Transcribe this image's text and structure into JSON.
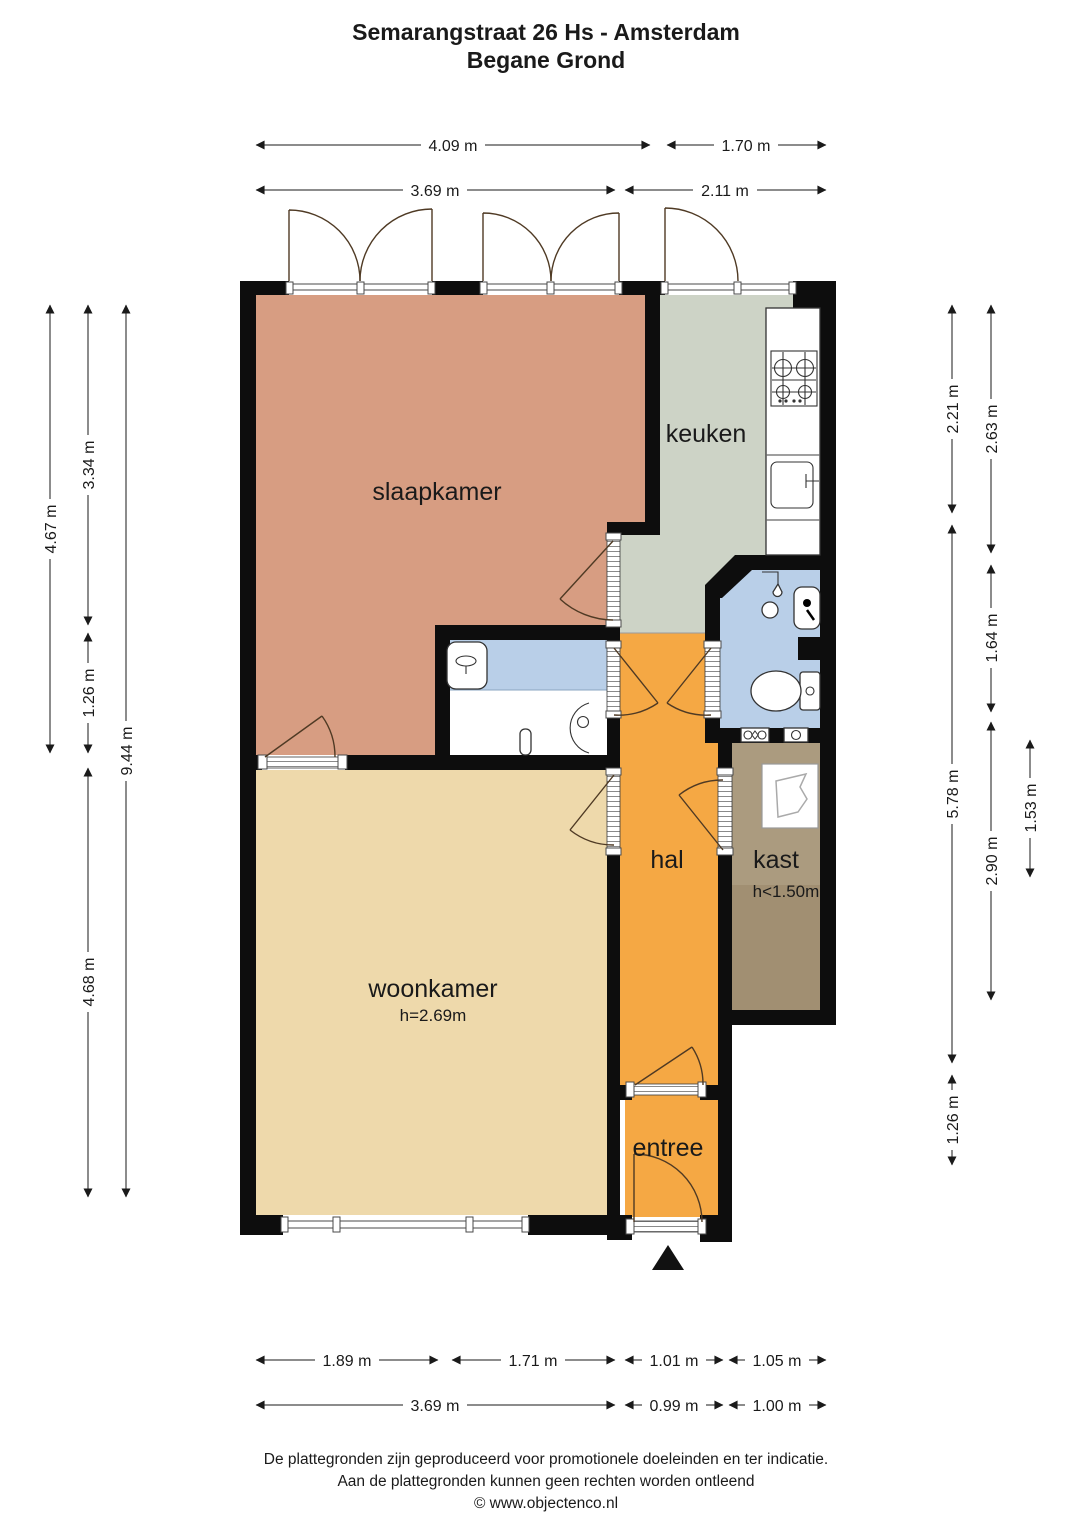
{
  "title": {
    "line1": "Semarangstraat 26 Hs - Amsterdam",
    "line2": "Begane Grond"
  },
  "rooms": {
    "slaapkamer": "slaapkamer",
    "keuken": "keuken",
    "hal": "hal",
    "kast": "kast",
    "kast_height": "h<1.50m",
    "woonkamer": "woonkamer",
    "woonkamer_height": "h=2.69m",
    "entree": "entree"
  },
  "dims": {
    "top_r1_a": "4.09 m",
    "top_r1_b": "1.70 m",
    "top_r2_a": "3.69 m",
    "top_r2_b": "2.11 m",
    "left_a": "4.67 m",
    "left_b1": "3.34 m",
    "left_b2": "1.26 m",
    "left_b3": "4.68 m",
    "left_c": "9.44 m",
    "right_a1": "2.21 m",
    "right_a2": "5.78 m",
    "right_a3": "1.26 m",
    "right_b1": "2.63 m",
    "right_b2": "1.64 m",
    "right_b3": "2.90 m",
    "right_c": "1.53 m",
    "bot_r1_a": "1.89 m",
    "bot_r1_b": "1.71 m",
    "bot_r1_c": "1.01 m",
    "bot_r1_d": "1.05 m",
    "bot_r2_a": "3.69 m",
    "bot_r2_b": "0.99 m",
    "bot_r2_c": "1.00 m"
  },
  "footer": {
    "line1": "De plattegronden zijn geproduceerd voor promotionele doeleinden en ter indicatie.",
    "line2": "Aan de plattegronden kunnen geen rechten worden ontleend",
    "line3": "© www.objectenco.nl"
  },
  "colors": {
    "slaapkamer": "#d79d82",
    "keuken": "#cdd3c6",
    "hal": "#f5a844",
    "entree": "#f5a844",
    "woonkamer": "#eed9ab",
    "kast": "#ab9b7f",
    "kast_low": "#a18f72",
    "wet_blue": "#b9cfe8",
    "bad_white": "#ffffff",
    "wall": "#0d0d0d"
  }
}
